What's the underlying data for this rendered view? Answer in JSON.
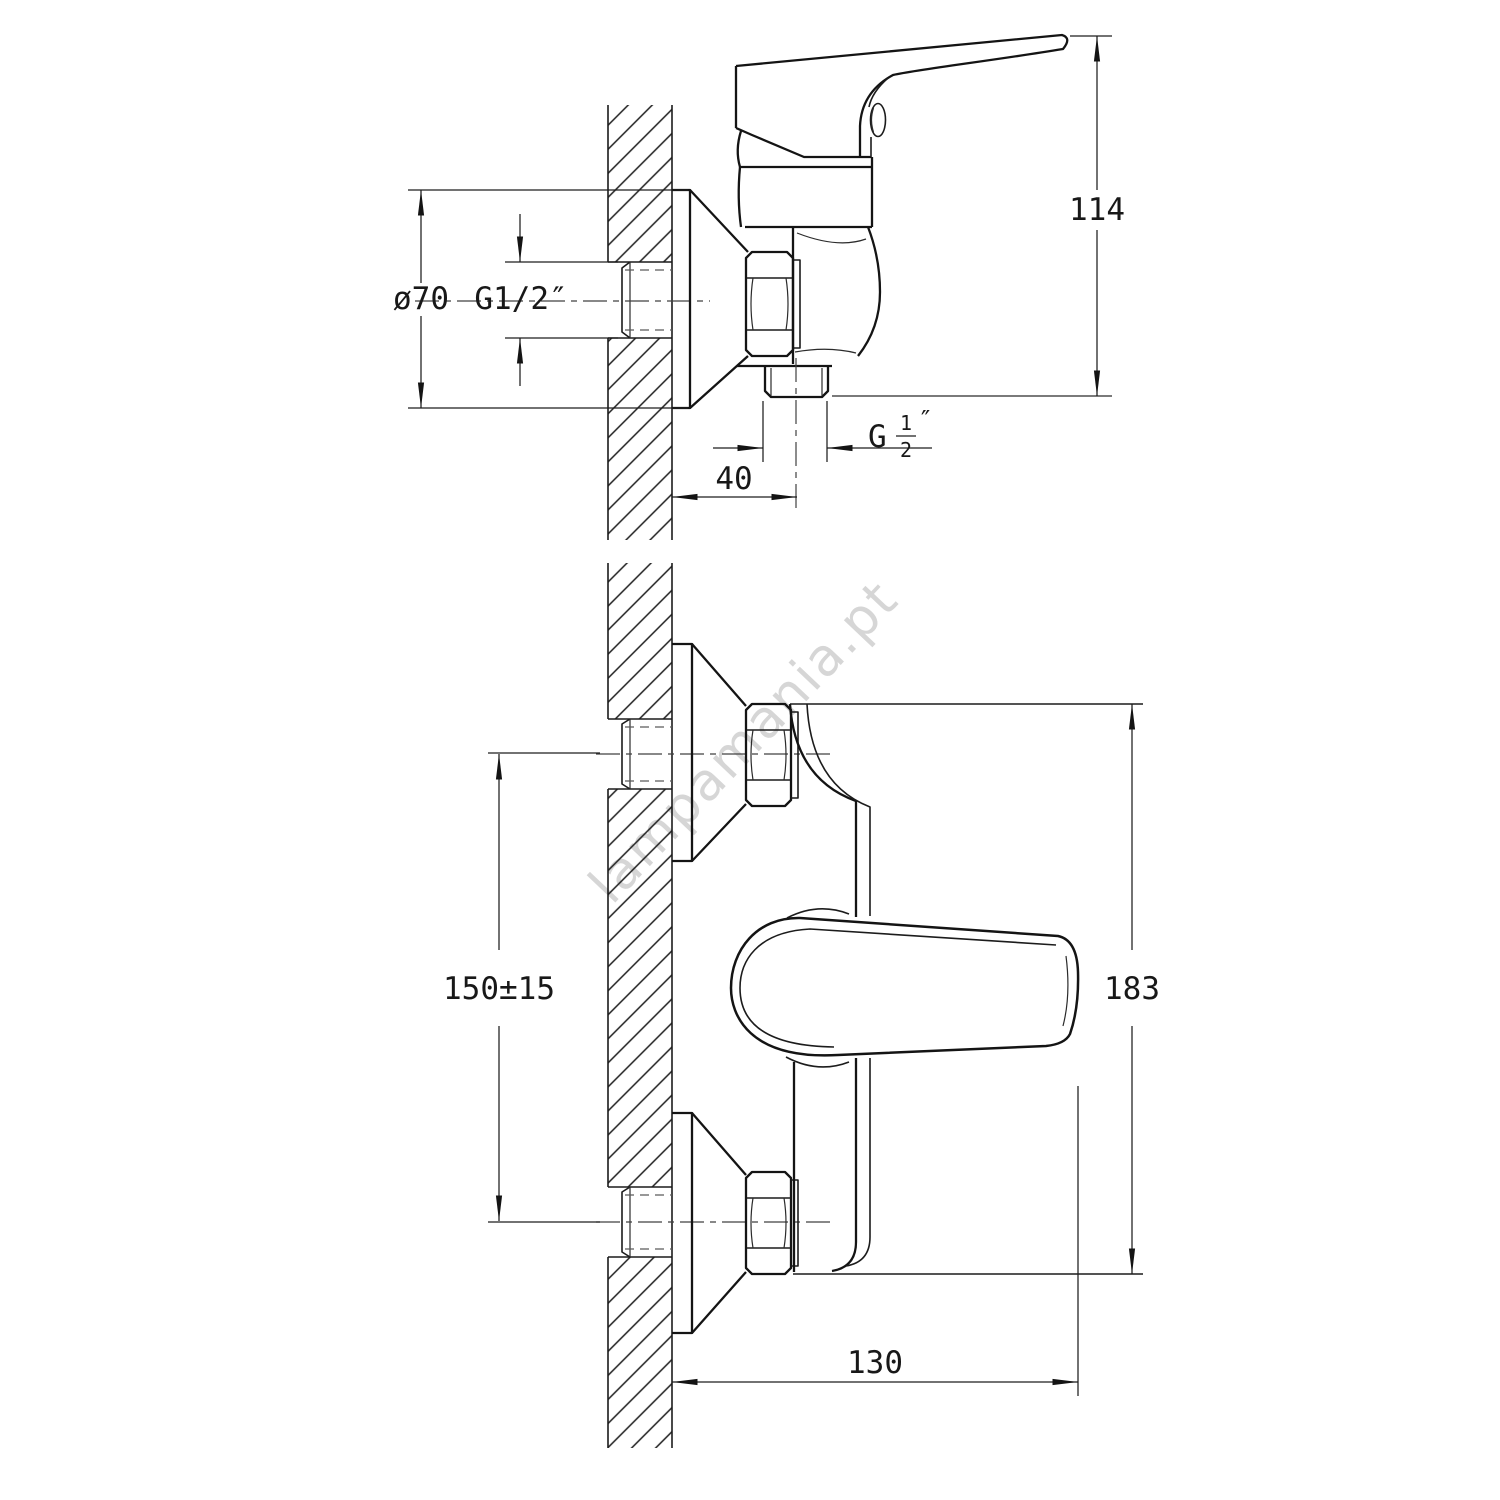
{
  "app": {
    "background": "#ffffff",
    "line_color": "#141414",
    "watermark_color": "#cccccc"
  },
  "watermark": {
    "text": "lampamania.pt"
  },
  "side_view": {
    "dims": {
      "flange_diameter": "ø70",
      "wall_thread": "G1/2″",
      "height": "114",
      "outlet_offset": "40",
      "outlet_thread": {
        "prefix": "G",
        "numerator": "1",
        "denominator": "2",
        "unit": "″"
      }
    }
  },
  "front_view": {
    "dims": {
      "inlet_spacing": "150±15",
      "overall_height": "183",
      "depth": "130"
    }
  }
}
